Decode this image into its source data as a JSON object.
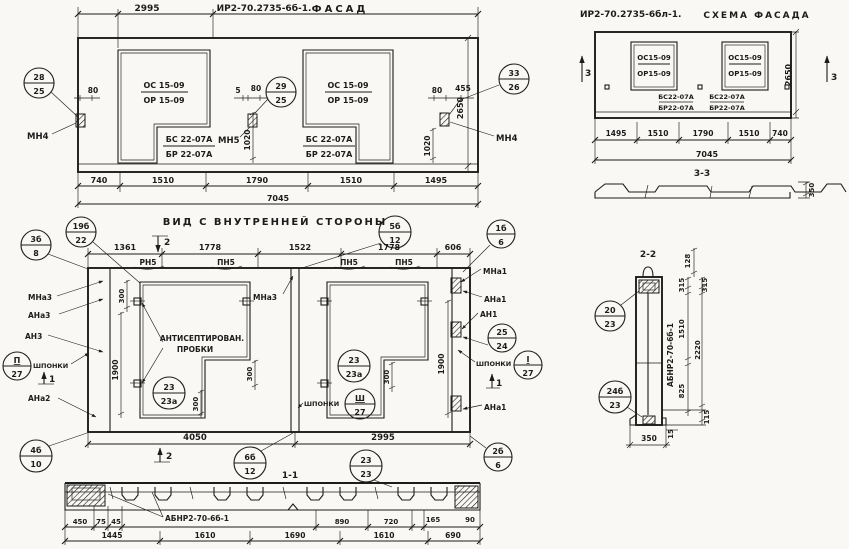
{
  "facade": {
    "dim_top": "2995",
    "title": "ИР2-70.2735-6б-1.",
    "subtitle": "ФАСАД",
    "balloon1": {
      "top": "28",
      "bot": "25"
    },
    "balloon2": {
      "top": "29",
      "bot": "25"
    },
    "balloon3": {
      "top": "33",
      "bot": "26"
    },
    "anchor_left": "МН4",
    "anchor_mid": "МН5",
    "anchor_right": "МН4",
    "win1": {
      "l1": "ОС 15-09",
      "l2": "ОР 15-09"
    },
    "win2": {
      "l1": "ОС 15-09",
      "l2": "ОР 15-09"
    },
    "sill1": {
      "l1": "БС 22-07А",
      "l2": "БР 22-07А"
    },
    "sill2": {
      "l1": "БС 22-07А",
      "l2": "БР 22-07А"
    },
    "d80a": "80",
    "d5": "5",
    "d80b": "80",
    "d80c": "80",
    "d455": "455",
    "d1020a": "1020",
    "d1020b": "1020",
    "d2650": "2650",
    "row1": [
      "740",
      "1510",
      "1790",
      "1510",
      "1495"
    ],
    "total": "7045"
  },
  "schema": {
    "title": "ИР2-70.2735-6бл-1.",
    "subtitle": "СХЕМА ФАСАДА",
    "win1": {
      "l1": "ОС15-09",
      "l2": "ОР15-09"
    },
    "win2": {
      "l1": "ОС15-09",
      "l2": "ОР15-09"
    },
    "sill1": {
      "l1": "БС22-07А",
      "l2": "БР22-07А"
    },
    "sill2": {
      "l1": "БС22-07А",
      "l2": "БР22-07А"
    },
    "sec_left": "3",
    "sec_right": "3",
    "d2650": "2650",
    "row1": [
      "1495",
      "1510",
      "1790",
      "1510",
      "740"
    ],
    "total": "7045",
    "sec33": "3-3",
    "d350": "350"
  },
  "inner": {
    "title": "ВИД С ВНУТРЕННЕЙ СТОРОНЫ",
    "top_dims": [
      "1361",
      "1778",
      "1522",
      "1778",
      "606"
    ],
    "sec2t": "2",
    "sec2b": "2",
    "sec1l": "1",
    "sec1r": "1",
    "pn": [
      "РН5",
      "ПН5",
      "ПН5",
      "ПН5"
    ],
    "b_3b8": {
      "top": "3б",
      "bot": "8"
    },
    "b_19b22": {
      "top": "19б",
      "bot": "22"
    },
    "b_5b12": {
      "top": "5б",
      "bot": "12"
    },
    "b_1b6": {
      "top": "1б",
      "bot": "6"
    },
    "b_23a_l": {
      "top": "23",
      "bot": "23а"
    },
    "b_23a_r": {
      "top": "23",
      "bot": "23а"
    },
    "b_25_24": {
      "top": "25",
      "bot": "24"
    },
    "b_k1": {
      "top": "П",
      "bot": "27"
    },
    "b_k2": {
      "top": "I",
      "bot": "27"
    },
    "b_k3": {
      "top": "Ш",
      "bot": "27"
    },
    "b_4b10": {
      "top": "4б",
      "bot": "10"
    },
    "b_6b12": {
      "top": "6б",
      "bot": "12"
    },
    "b_2323": {
      "top": "23",
      "bot": "23"
    },
    "b_2b6": {
      "top": "2б",
      "bot": "6"
    },
    "lbl_mna3_l": "МНа3",
    "lbl_ana3": "АНа3",
    "lbl_an3": "АН3",
    "lbl_shponki_l": "ШПОНКИ",
    "lbl_ana2": "АНа2",
    "lbl_mna3_m": "МНа3",
    "lbl_mna1": "МНа1",
    "lbl_ana1_t": "АНа1",
    "lbl_an1": "АН1",
    "lbl_shponki_r": "ШПОНКИ",
    "lbl_ana1_b": "АНа1",
    "lbl_shponki_m": "ШПОНКИ",
    "note1": "АНТИСЕПТИРОВАН.",
    "note2": "ПРОБКИ",
    "d300t": "300",
    "d1900l": "1900",
    "d1900r": "1900",
    "d300a": "300",
    "d300b": "300",
    "d300c": "300",
    "d4050": "4050",
    "d2995": "2995",
    "sec11": "1-1"
  },
  "section11": {
    "label": "АБНР2-70-6б-1",
    "row1": [
      "450",
      "75",
      "45",
      "890",
      "720",
      "165",
      "90"
    ],
    "row2": [
      "1445",
      "1610",
      "1690",
      "1610",
      "690"
    ]
  },
  "section22": {
    "title": "2-2",
    "label": "АБНР2-70-6б-1",
    "d128": "128",
    "d315a": "315",
    "d315b": "315",
    "d1510": "1510",
    "d2220": "2220",
    "d825": "825",
    "d115": "115",
    "d350": "350",
    "d15": "15",
    "b_2023": {
      "top": "20",
      "bot": "23"
    },
    "b_24b23": {
      "top": "24б",
      "bot": "23"
    }
  }
}
